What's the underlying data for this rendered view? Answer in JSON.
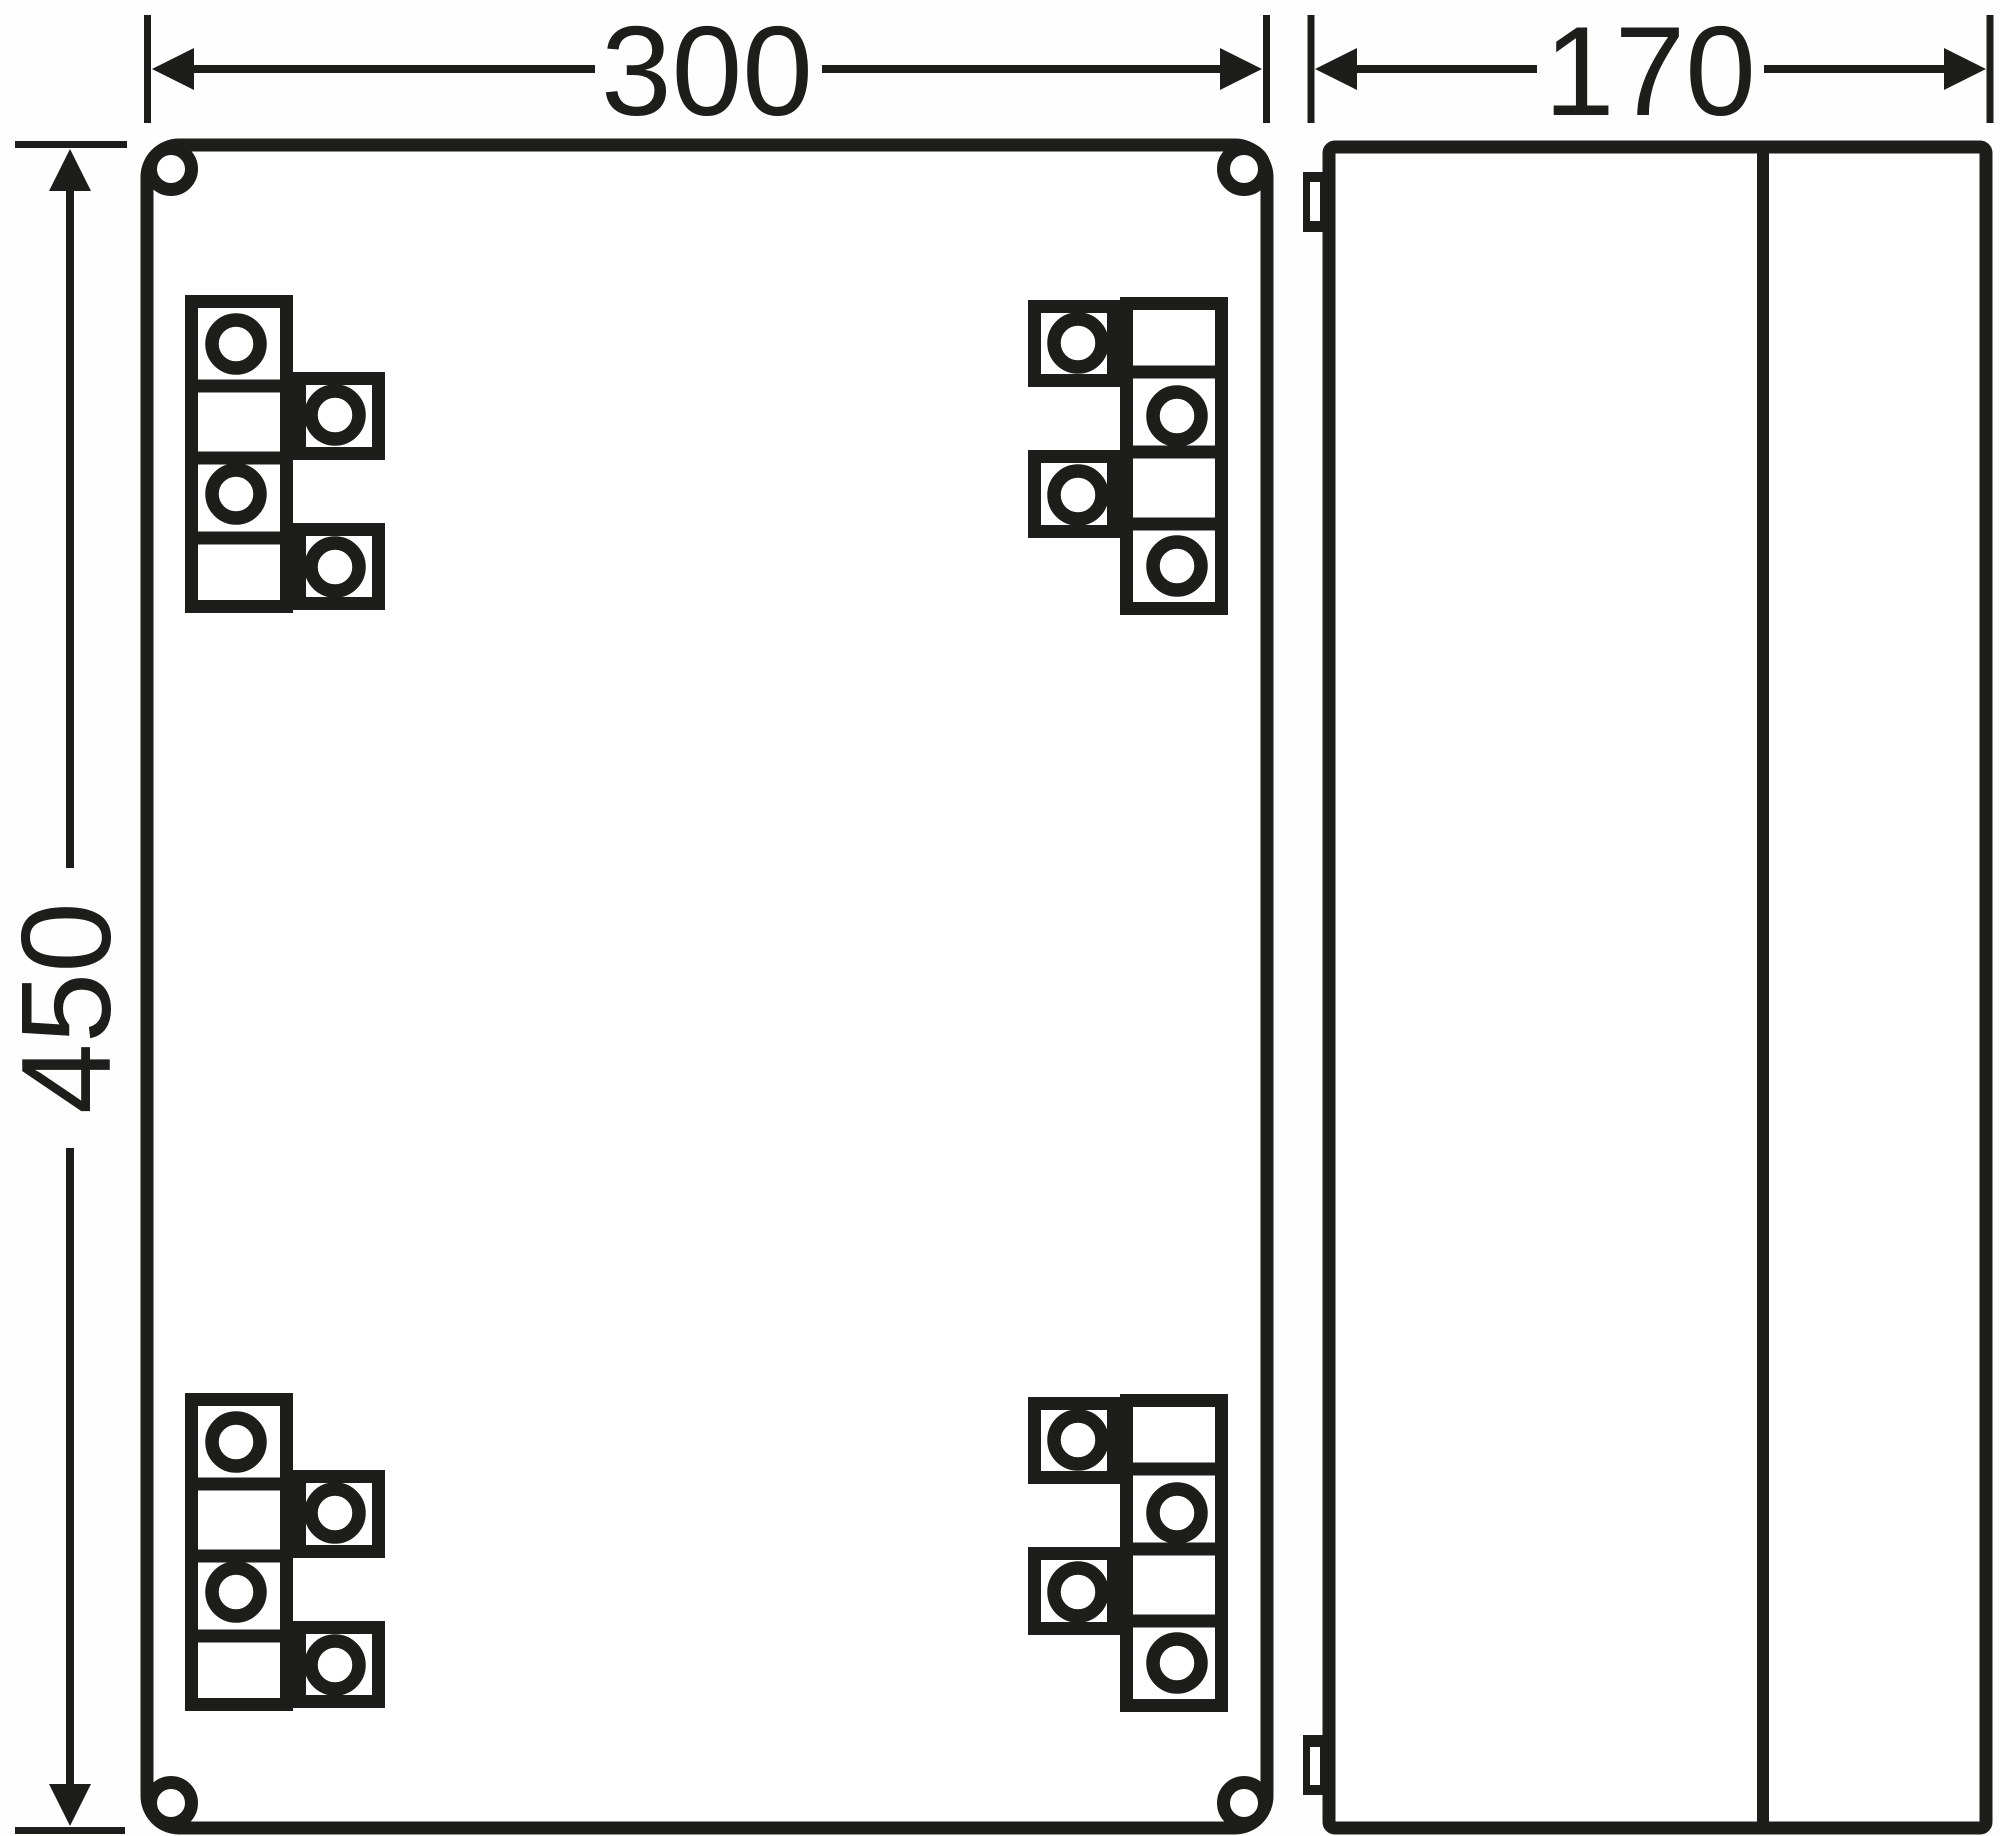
{
  "dimensions": {
    "width_label": "300",
    "depth_label": "170",
    "height_label": "450"
  },
  "colors": {
    "ink": "#1d1d1b",
    "paper": "#fefefe"
  }
}
